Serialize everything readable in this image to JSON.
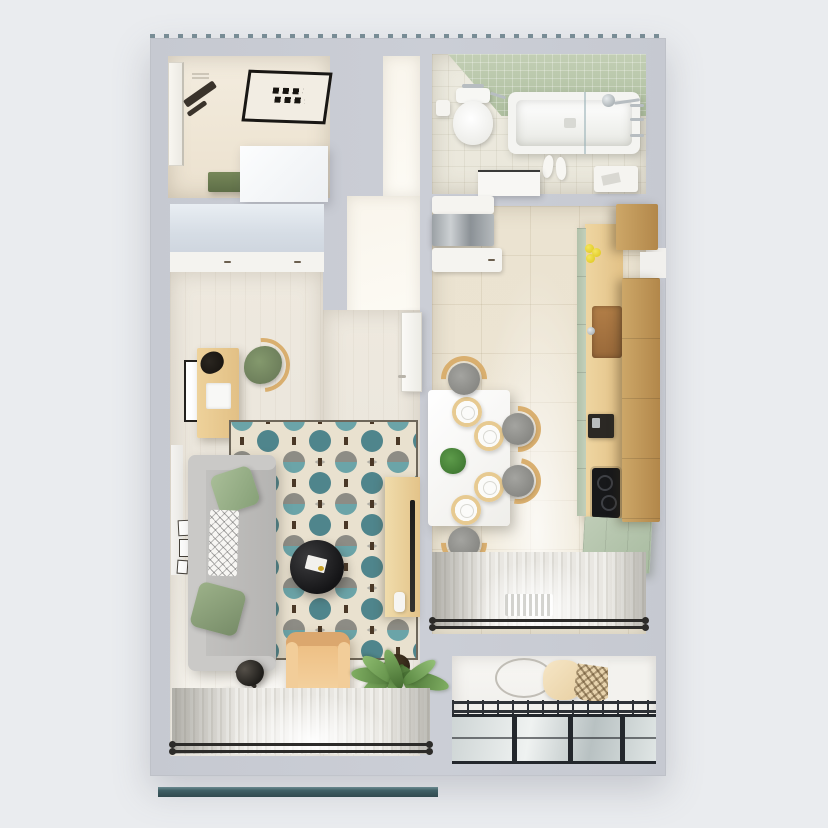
{
  "scene": {
    "description": "3D top-down render of a one-room apartment floor plan",
    "colors": {
      "bg": "#eaecef",
      "wall": "#c8cbd3",
      "hall_floor": "#f1e9da",
      "living_floor": "#ece8df",
      "kitchen_floor": "#ece4d2",
      "bath_floor": "#ebe9de",
      "bath_tile": "#b7c6aa",
      "wood": "#e9cf9a",
      "wood_dark": "#bb904f",
      "sage": "#9db28c",
      "sage_dark": "#6c7c55",
      "cabinet_sage": "#b9c8b0",
      "sofa": "#bcbbb9",
      "rug_teal": "#68a2a7",
      "rug_gray": "#8d8c85",
      "rug_cream": "#e9e1cf",
      "charcoal": "#27262a",
      "tan": "#edbd83",
      "plant": "#5f8f45",
      "glass": "#ccd3d3",
      "frame_dark": "#2d3237",
      "curtain": "#e7e5e0",
      "facade": "#3f5f65",
      "white": "#f6f5f2"
    },
    "rooms": [
      {
        "id": "hallway",
        "objects": [
          "entrance-door",
          "ventilation-grille",
          "coat-rack",
          "doormat",
          "bench",
          "storage-box",
          "wardrobe"
        ]
      },
      {
        "id": "living-room",
        "objects": [
          "picture-frame",
          "desk",
          "laptop",
          "bag",
          "desk-chair",
          "area-rug",
          "corner-sofa",
          "green-pillows",
          "patterned-throw",
          "coffee-table",
          "book",
          "floor-lamp",
          "armchair",
          "potted-plant",
          "tv-panel",
          "open-door",
          "gallery-frames",
          "sheer-curtains",
          "curtain-rod",
          "window"
        ]
      },
      {
        "id": "bathroom",
        "objects": [
          "green-tile-wall",
          "bathtub",
          "glass-screen",
          "shower-set",
          "toilet",
          "toilet-paper-holder",
          "towel-bar",
          "slippers",
          "vanity",
          "side-cabinet"
        ]
      },
      {
        "id": "kitchen",
        "objects": [
          "refrigerator",
          "countertop",
          "sink",
          "faucet",
          "lemons",
          "coffee-machine",
          "cooktop",
          "green-cabinet",
          "upper-cabinets",
          "dining-table",
          "plates",
          "table-plant",
          "chairs",
          "sheer-curtains",
          "curtain-rod",
          "radiator",
          "window"
        ]
      },
      {
        "id": "balcony",
        "objects": [
          "hanging-chair",
          "white-column",
          "glazed-railing"
        ]
      }
    ]
  }
}
